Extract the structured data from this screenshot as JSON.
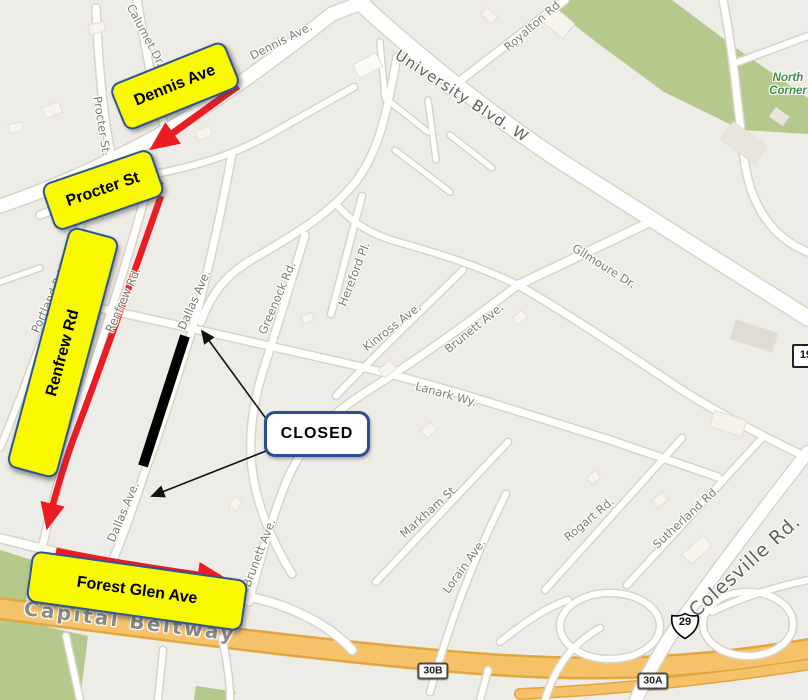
{
  "detour": {
    "dennis": "Dennis Ave",
    "procter": "Procter St",
    "renfrew": "Renfrew Rd",
    "forest_glen": "Forest Glen Ave",
    "closed": "CLOSED"
  },
  "streets": [
    {
      "text": "Calumet Dr."
    },
    {
      "text": "Dennis Ave."
    },
    {
      "text": "Procter St."
    },
    {
      "text": "Royalton Rd"
    },
    {
      "text": "University Blvd. W"
    },
    {
      "text": "Gilmoure Dr."
    },
    {
      "text": "Dallas Ave."
    },
    {
      "text": "Greenock Rd."
    },
    {
      "text": "Hereford Pl."
    },
    {
      "text": "Kinross Ave."
    },
    {
      "text": "Brunett Ave."
    },
    {
      "text": "Lanark Wy."
    },
    {
      "text": "Portland Rd."
    },
    {
      "text": "Renfrew Rd."
    },
    {
      "text": "Dallas Ave."
    },
    {
      "text": "Brunett Ave."
    },
    {
      "text": "Markham St."
    },
    {
      "text": "Lorain Ave."
    },
    {
      "text": "Rogart Rd."
    },
    {
      "text": "Sutherland Rd."
    },
    {
      "text": "Colesville Rd."
    },
    {
      "text": "Capital Beltway"
    }
  ],
  "place": {
    "line1": "North",
    "line2": "Corner"
  },
  "shields": {
    "exit_b": "30B",
    "exit_a": "30A",
    "us29": "29",
    "md193": "193"
  },
  "colors": {
    "detour_yellow": "#F9F900",
    "detour_border": "#2E5690",
    "detour_red": "#ED1C24",
    "closed_black": "#000000",
    "park_green": "#B5C98C",
    "beltway_orange": "#F6C269",
    "map_background": "#EDECE6"
  }
}
